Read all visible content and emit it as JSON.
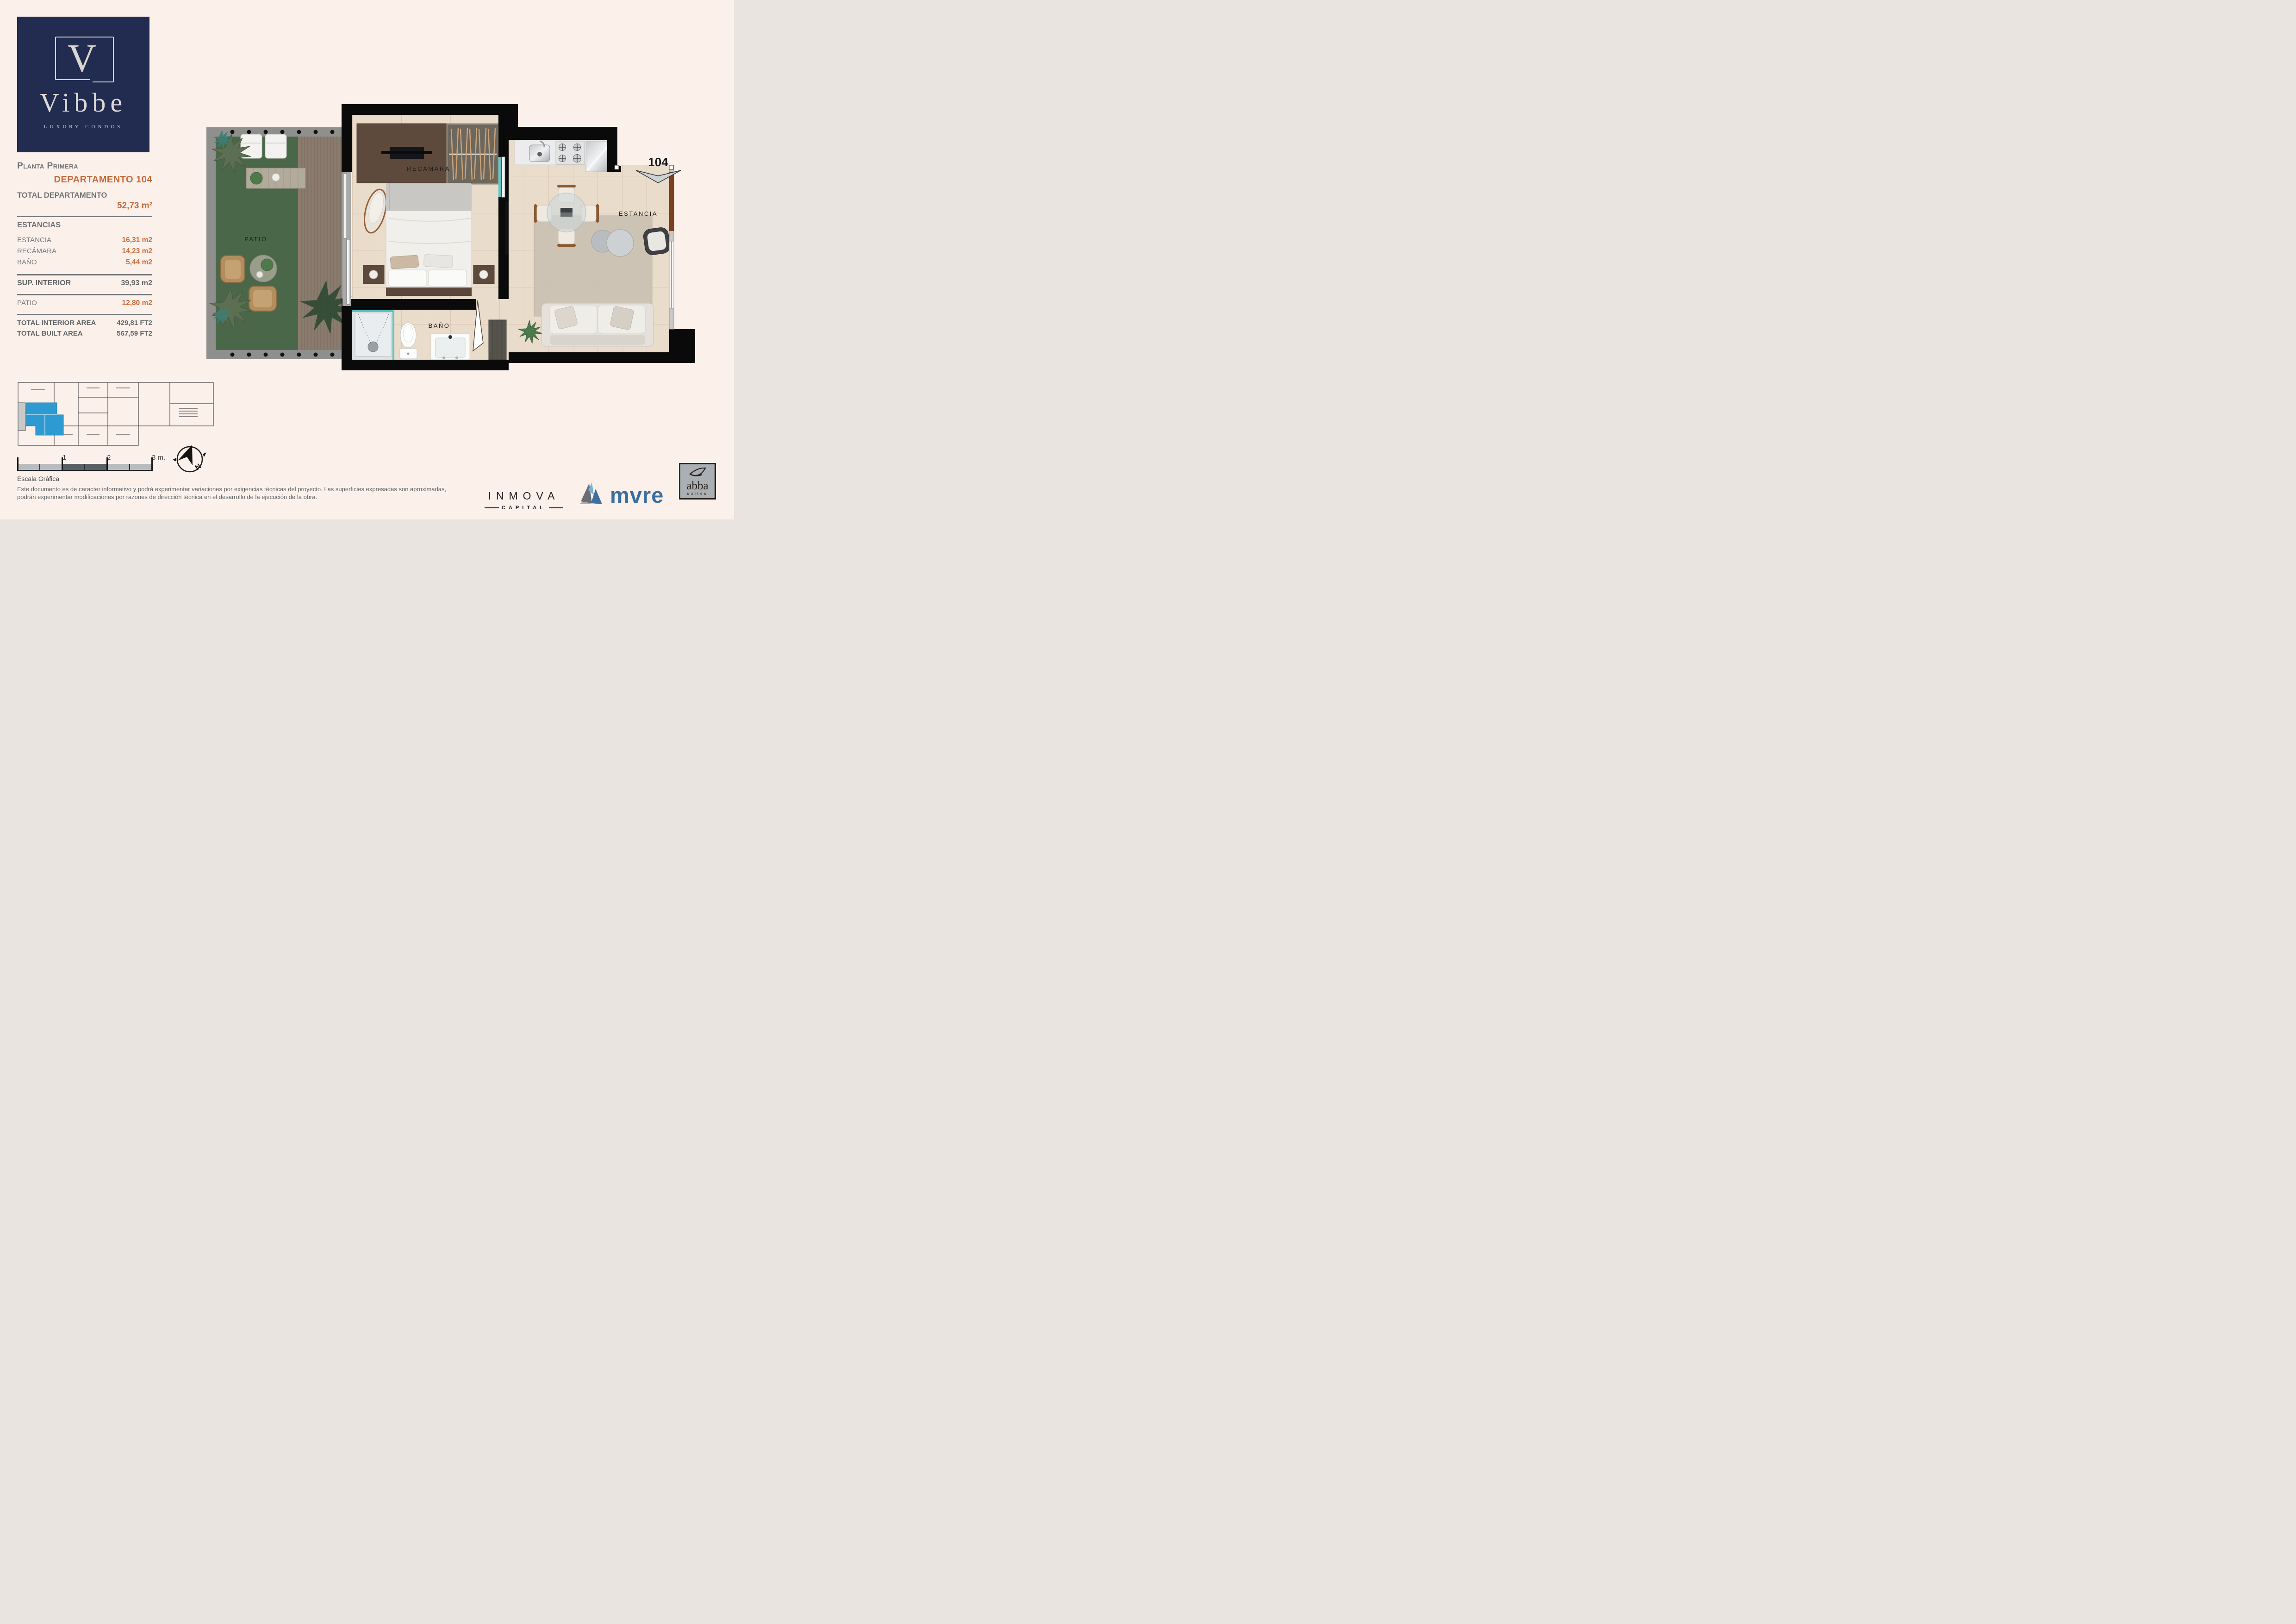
{
  "logo": {
    "initial": "V",
    "name": "Vibbe",
    "tagline": "LUXURY CONDOS"
  },
  "panel": {
    "floor": "Planta Primera",
    "unit_title": "DEPARTAMENTO 104",
    "total_label": "TOTAL DEPARTAMENTO",
    "total_value": "52,73 m²",
    "rooms_heading": "ESTANCIAS",
    "rooms": [
      {
        "label": "ESTANCIA",
        "value": "16,31 m2"
      },
      {
        "label": "RECÁMARA",
        "value": "14,23 m2"
      },
      {
        "label": "BAÑO",
        "value": "5,44 m2"
      }
    ],
    "interior_label": "SUP. INTERIOR",
    "interior_value": "39,93 m2",
    "patio_label": "PATIO",
    "patio_value": "12,80 m2",
    "totals": [
      {
        "label": "TOTAL INTERIOR AREA",
        "value": "429,81 FT2"
      },
      {
        "label": "TOTAL BUILT AREA",
        "value": "567,59 FT2"
      }
    ]
  },
  "plan": {
    "labels": {
      "recamara": "RECÁMARA",
      "patio": "PATIO",
      "bano": "BAÑO",
      "estancia": "ESTANCIA",
      "unit_number": "104"
    }
  },
  "scale_bar": {
    "ticks": [
      "1",
      "2",
      "3 m."
    ],
    "caption": "Escala Gráfica",
    "north_label": "N"
  },
  "disclaimer": {
    "line1": "Este documento es de caracter informativo y podrá experimentar variaciones por exigencias técnicas del proyecto. Las superficies expresadas son aproximadas,",
    "line2": "podrán experimentar modificaciones por razones de dirección técnica en el desarrollo de la ejecución de la obra."
  },
  "brands": {
    "inmova": {
      "name": "INMOVA",
      "sub": "CAPITAL"
    },
    "mvre": {
      "name": "mvre"
    },
    "abba": {
      "name": "abba",
      "sub": "suites"
    }
  },
  "colors": {
    "background": "#fcf1ea",
    "navy": "#222b50",
    "accent_orange": "#c4693a",
    "text_gray": "#6e7277",
    "wall_black": "#0a0a0a",
    "grass_green": "#4d6b4c",
    "highlight_blue": "#2d9bd1",
    "mvre_blue": "#3a6f9f"
  }
}
